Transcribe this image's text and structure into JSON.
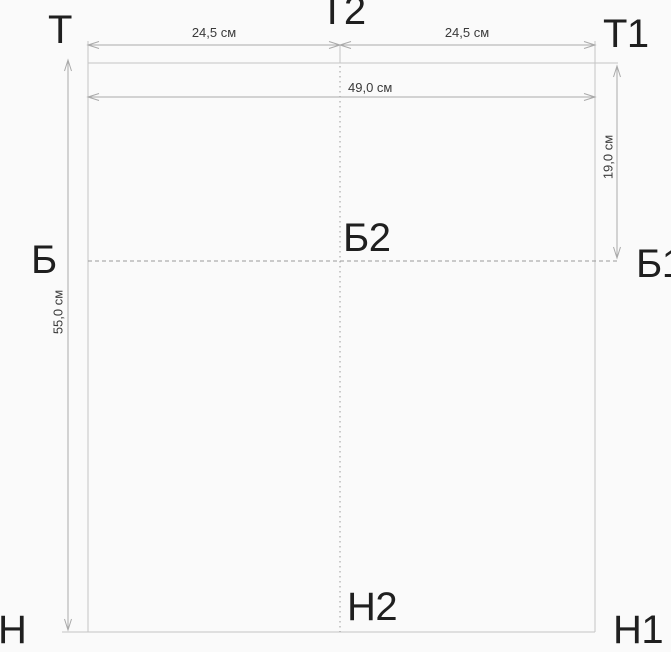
{
  "diagram": {
    "type": "sewing-pattern-draft-grid",
    "points": {
      "t": {
        "label": "Т"
      },
      "t2": {
        "label": "Т2"
      },
      "t1": {
        "label": "Т1"
      },
      "b": {
        "label": "Б"
      },
      "b2": {
        "label": "Б2"
      },
      "b1": {
        "label": "Б1"
      },
      "n": {
        "label": "Н"
      },
      "n2": {
        "label": "Н2"
      },
      "n1": {
        "label": "Н1"
      }
    },
    "dimensions": {
      "waist_left_half": {
        "label": "24,5 см"
      },
      "waist_right_half": {
        "label": "24,5 см"
      },
      "full_width": {
        "label": "49,0 см"
      },
      "side_length": {
        "label": "55,0 см"
      },
      "hip_depth": {
        "label": "19,0 см"
      }
    },
    "colors": {
      "background": "#fafafa",
      "outline": "#c4c4c4",
      "dimension_line": "#a9a9a9",
      "guide_line": "#9b9b9b",
      "point_text": "#1f1f1f",
      "dimension_text": "#3a3a3a"
    }
  }
}
